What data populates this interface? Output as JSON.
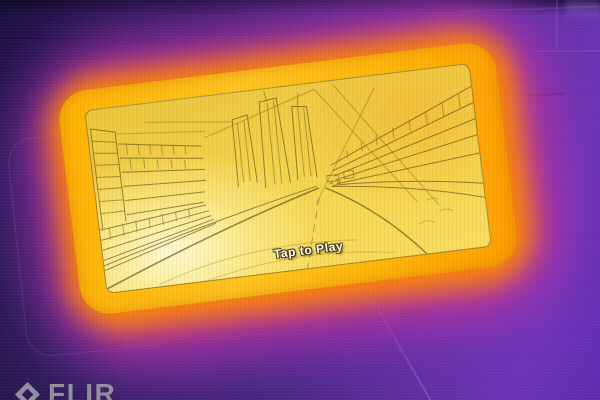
{
  "photo": {
    "kind": "thermal-camera-capture",
    "subject": "hot smartphone on textured surface, screen showing city driving game in edge-detect thermal view"
  },
  "phone": {
    "tap_label": "Tap to Play",
    "screen_content": [
      "city-skyline",
      "skyscrapers",
      "elevated-track",
      "curving-road",
      "buildings-left"
    ]
  },
  "watermark": {
    "brand": "FLIR",
    "icon": "flir-spark-icon"
  },
  "palette": {
    "bg_dark_indigo": "#221749",
    "bg_violet": "#5e30a2",
    "glow_violet": "#7b35c0",
    "glow_magenta": "#cf2f95",
    "glow_orange": "#ff8a00",
    "phone_hot_yellow": "#ffc41e",
    "screen_yellow": "#f6d64f",
    "screen_hotspot": "#fffad2",
    "edge_line_olive": "#5a490f",
    "watermark_grey": "#8f8f9e",
    "text_white": "#fdfdf8"
  }
}
